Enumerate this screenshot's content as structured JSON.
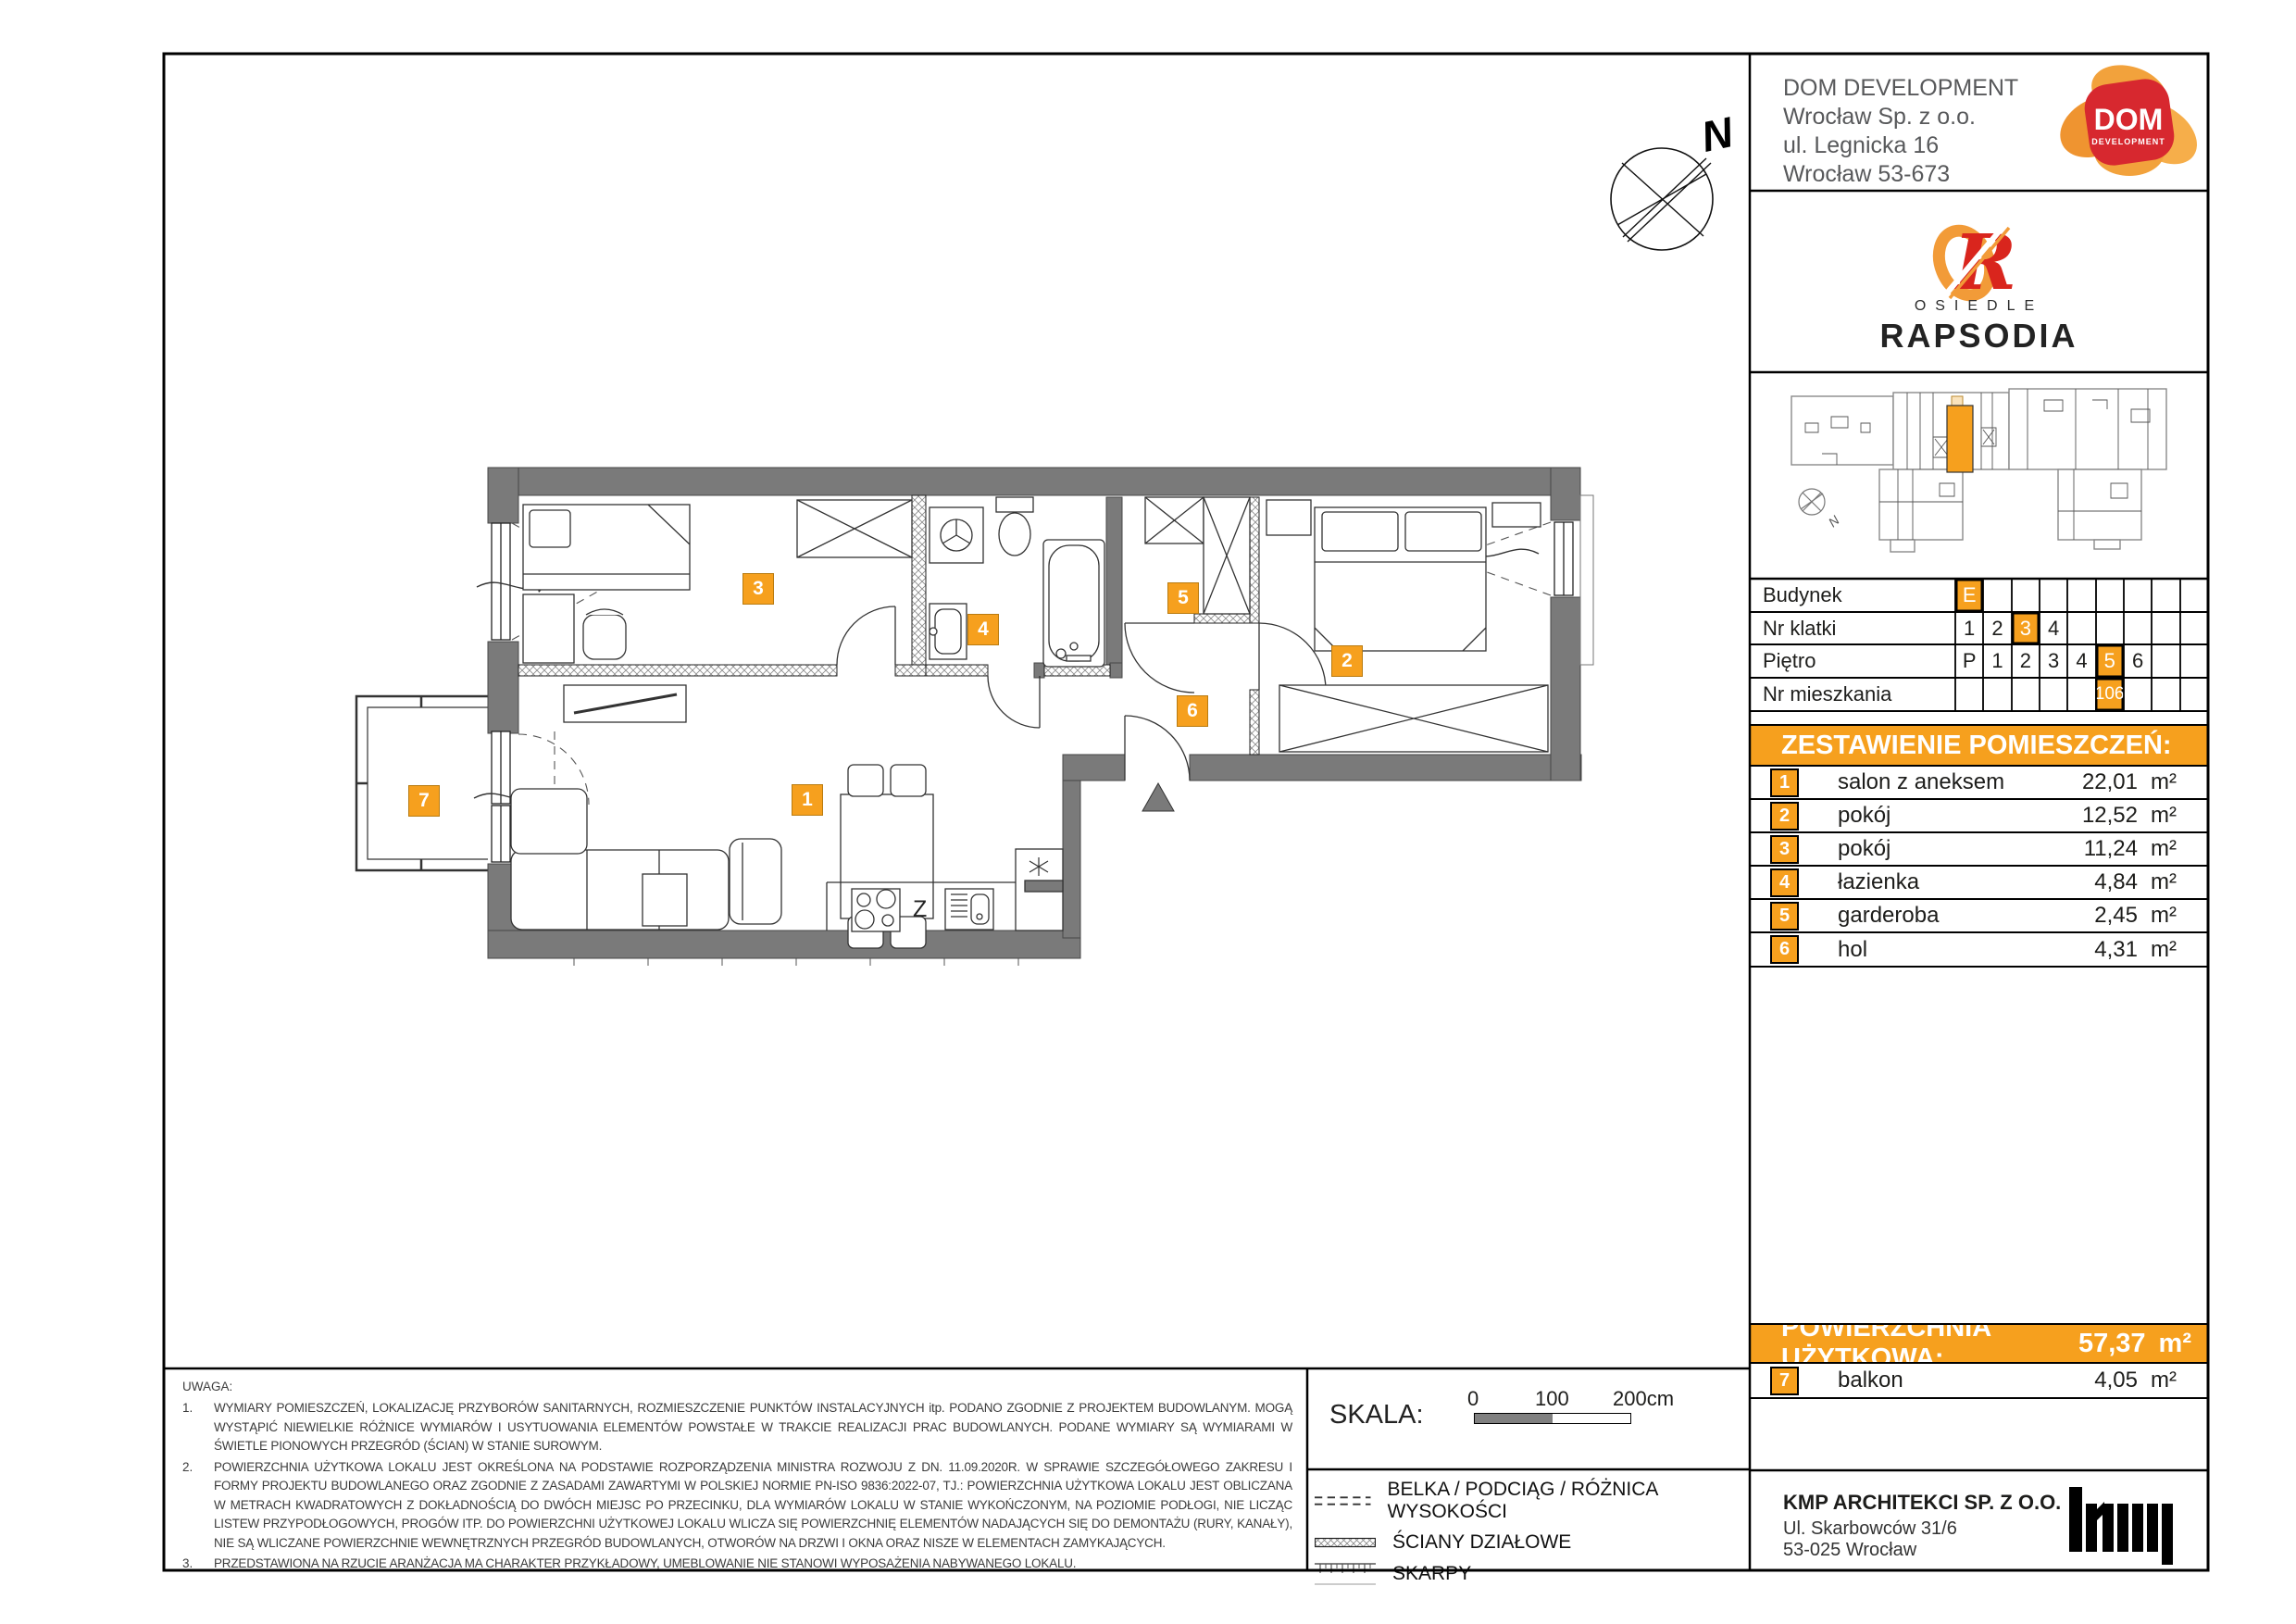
{
  "company": {
    "name": "DOM DEVELOPMENT",
    "line2": "Wrocław Sp. z o.o.",
    "line3": "ul. Legnicka 16",
    "line4": "Wrocław 53-673",
    "line5": "tel. 71 747 74 74",
    "logo_main": "DOM",
    "logo_sub": "DEVELOPMENT"
  },
  "estate": {
    "letter": "R",
    "line1": "OSIEDLE",
    "line2": "RAPSODIA"
  },
  "unit_table": {
    "rows": [
      {
        "label": "Budynek",
        "cells": [
          "E",
          "",
          "",
          "",
          "",
          "",
          "",
          "",
          ""
        ]
      },
      {
        "label": "Nr klatki",
        "cells": [
          "1",
          "2",
          "3",
          "4",
          "",
          "",
          "",
          "",
          ""
        ]
      },
      {
        "label": "Piętro",
        "cells": [
          "P",
          "1",
          "2",
          "3",
          "4",
          "5",
          "6",
          "",
          ""
        ]
      },
      {
        "label": "Nr mieszkania",
        "cells": [
          "",
          "",
          "",
          "",
          "",
          "106",
          "",
          "",
          ""
        ]
      }
    ]
  },
  "rooms_header": "ZESTAWIENIE POMIESZCZEŃ:",
  "rooms": [
    {
      "no": "1",
      "name": "salon z aneksem",
      "area": "22,01",
      "unit": "m²"
    },
    {
      "no": "2",
      "name": "pokój",
      "area": "12,52",
      "unit": "m²"
    },
    {
      "no": "3",
      "name": "pokój",
      "area": "11,24",
      "unit": "m²"
    },
    {
      "no": "4",
      "name": "łazienka",
      "area": "4,84",
      "unit": "m²"
    },
    {
      "no": "5",
      "name": "garderoba",
      "area": "2,45",
      "unit": "m²"
    },
    {
      "no": "6",
      "name": "hol",
      "area": "4,31",
      "unit": "m²"
    }
  ],
  "total": {
    "label": "POWIERZCHNIA UŻYTKOWA:",
    "value": "57,37",
    "unit": "m²"
  },
  "balcony_row": {
    "no": "7",
    "name": "balkon",
    "area": "4,05",
    "unit": "m²"
  },
  "notes": {
    "title": "UWAGA:",
    "items": [
      {
        "no": "1.",
        "text": "WYMIARY POMIESZCZEŃ, LOKALIZACJĘ PRZYBORÓW SANITARNYCH, ROZMIESZCZENIE PUNKTÓW INSTALACYJNYCH itp. PODANO ZGODNIE Z PROJEKTEM BUDOWLANYM. MOGĄ WYSTĄPIĆ NIEWIELKIE RÓŻNICE WYMIARÓW I USYTUOWANIA ELEMENTÓW POWSTAŁE W TRAKCIE REALIZACJI PRAC BUDOWLANYCH. PODANE WYMIARY SĄ WYMIARAMI W ŚWIETLE PIONOWYCH PRZEGRÓD (ŚCIAN) W STANIE SUROWYM."
      },
      {
        "no": "2.",
        "text": "POWIERZCHNIA UŻYTKOWA LOKALU JEST OKREŚLONA NA PODSTAWIE ROZPORZĄDZENIA MINISTRA ROZWOJU Z DN. 11.09.2020R. W SPRAWIE SZCZEGÓŁOWEGO ZAKRESU I FORMY PROJEKTU BUDOWLANEGO ORAZ ZGODNIE Z ZASADAMI ZAWARTYMI W POLSKIEJ NORMIE PN-ISO 9836:2022-07, TJ.: POWIERZCHNIA UŻYTKOWA LOKALU JEST OBLICZANA W METRACH KWADRATOWYCH Z DOKŁADNOŚCIĄ DO DWÓCH MIEJSC PO PRZECINKU, DLA WYMIARÓW LOKALU W STANIE WYKOŃCZONYM, NA POZIOMIE PODŁOGI, NIE LICZĄC LISTEW PRZYPODŁOGOWYCH, PROGÓW ITP. DO POWIERZCHNI UŻYTKOWEJ LOKALU WLICZA SIĘ POWIERZCHNIĘ ELEMENTÓW NADAJĄCYCH SIĘ DO DEMONTAŻU (RURY, KANAŁY), NIE SĄ WLICZANE POWIERZCHNIE WEWNĘTRZNYCH PRZEGRÓD BUDOWLANYCH, OTWORÓW NA DRZWI I OKNA ORAZ NISZE W ELEMENTACH ZAMYKAJĄCYCH."
      },
      {
        "no": "3.",
        "text": "PRZEDSTAWIONA NA RZUCIE ARANŻACJA MA CHARAKTER PRZYKŁADOWY, UMEBLOWANIE NIE STANOWI WYPOSAŻENIA NABYWANEGO LOKALU."
      }
    ]
  },
  "scale": {
    "label": "SKALA:",
    "tick0": "0",
    "tick100": "100",
    "tick200": "200cm"
  },
  "legend": [
    {
      "label": "BELKA / PODCIĄG / RÓŻNICA WYSOKOŚCI"
    },
    {
      "label": "ŚCIANY DZIAŁOWE"
    },
    {
      "label": "SKARPY"
    }
  ],
  "architect": {
    "name": "KMP ARCHITEKCI SP. Z O.O.",
    "line2": "Ul. Skarbowców 31/6",
    "line3": "53-025 Wrocław"
  },
  "plan": {
    "badges": [
      {
        "no": "1"
      },
      {
        "no": "2"
      },
      {
        "no": "3"
      },
      {
        "no": "4"
      },
      {
        "no": "5"
      },
      {
        "no": "6"
      },
      {
        "no": "7"
      }
    ],
    "compass": "N",
    "kitchen_label": "Z"
  },
  "mini_plan": {
    "compass": "N"
  },
  "colors": {
    "accent": "#F6A01E",
    "wall": "#7A7A7A",
    "logo_red": "#D7282F",
    "logo_orange": "#F0973B"
  }
}
